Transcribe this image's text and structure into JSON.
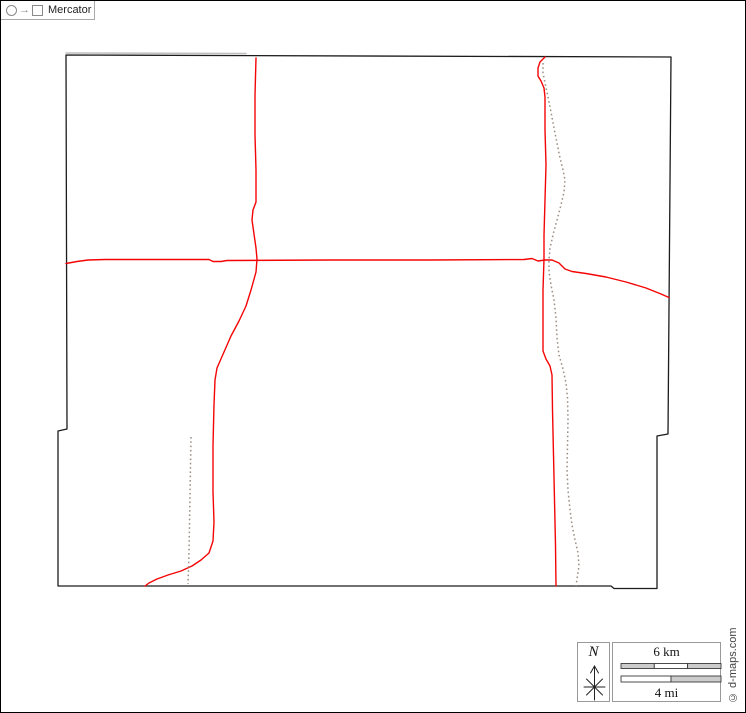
{
  "map": {
    "colors": {
      "outline": "#1c1c1c",
      "neighbor": "#bfbfbf",
      "road": "#f40505",
      "waterway": "#9b9086"
    },
    "features": [
      {
        "name": "county-outline",
        "kind": "outline",
        "closed": true,
        "points": "66,55 671,57 668,434 657,436 657,588.5 614,588.5 611,586 58,586 58,431 67,429"
      },
      {
        "name": "neighbor-boundary-top",
        "kind": "neighbor",
        "closed": false,
        "points": "66,53 246,53.5"
      },
      {
        "name": "road-west",
        "kind": "road",
        "closed": false,
        "points": "256,58 255,95 255,135 256,170 256,202 253,210 252,220 254,234 256,248 257,259 256,272 251,290 246,306 239,321 231,336 224,352 217,368 215,380 214,405 213,445 213,492 214,522 213,541 209,553 201,560 192,566 181,571 168,575 157,579 149,583 145,586"
      },
      {
        "name": "road-horizontal",
        "kind": "road",
        "closed": false,
        "points": "66,263.5 77,261.5 88,260 105,259.5 209,259.5 213,261.5 221,261.5 227,260.5 330,260 430,260 524,259.5 532,258.5 538,261 545,260 552,260 559,263 565,269 572,271.5 586,273.5 606,277 626,282 646,288 661,294 669,297.5"
      },
      {
        "name": "road-east",
        "kind": "road",
        "closed": false,
        "points": "545,57 540,62 538,68 538,76 541,81 544,88 545,97 545,130 546,165 545,200 544,235 544,259 543,290 543,330 543,351 546,359 550,366 552,375 552.5,410 553.5,455 554.5,500 555.5,545 556,586"
      },
      {
        "name": "stream-east-dashed",
        "kind": "waterway",
        "closed": false,
        "points": "543,63 543,73 545,83 548,97 551,112 554,128 557,143 560,158 563,170 565,180 564,192 561,205 557,220 553,235 550,248 549,260 549,272 551,285 554,300 556,318 557,338 559,355 563,369 566,383 567.5,398 568,420 567.5,445 567,470 568,490 570,510 572,525 575,540 578,553 579,566 577,579 576,586"
      },
      {
        "name": "stream-west-dashed",
        "kind": "waterway",
        "closed": false,
        "points": "191,437 190.5,465 190,495 189.5,525 189,552 188.5,570 188,584"
      }
    ]
  },
  "legend": {
    "north": {
      "label": "N"
    },
    "scale": {
      "km_label": "6 km",
      "mi_label": "4 mi",
      "bar_gray": "#cccccc",
      "km_segments": [
        "gray",
        "white",
        "gray"
      ],
      "mi_segments": [
        "white",
        "gray"
      ]
    },
    "projection": {
      "arrow": "→",
      "label": "Mercator"
    },
    "copyright": "© d-maps.com"
  }
}
